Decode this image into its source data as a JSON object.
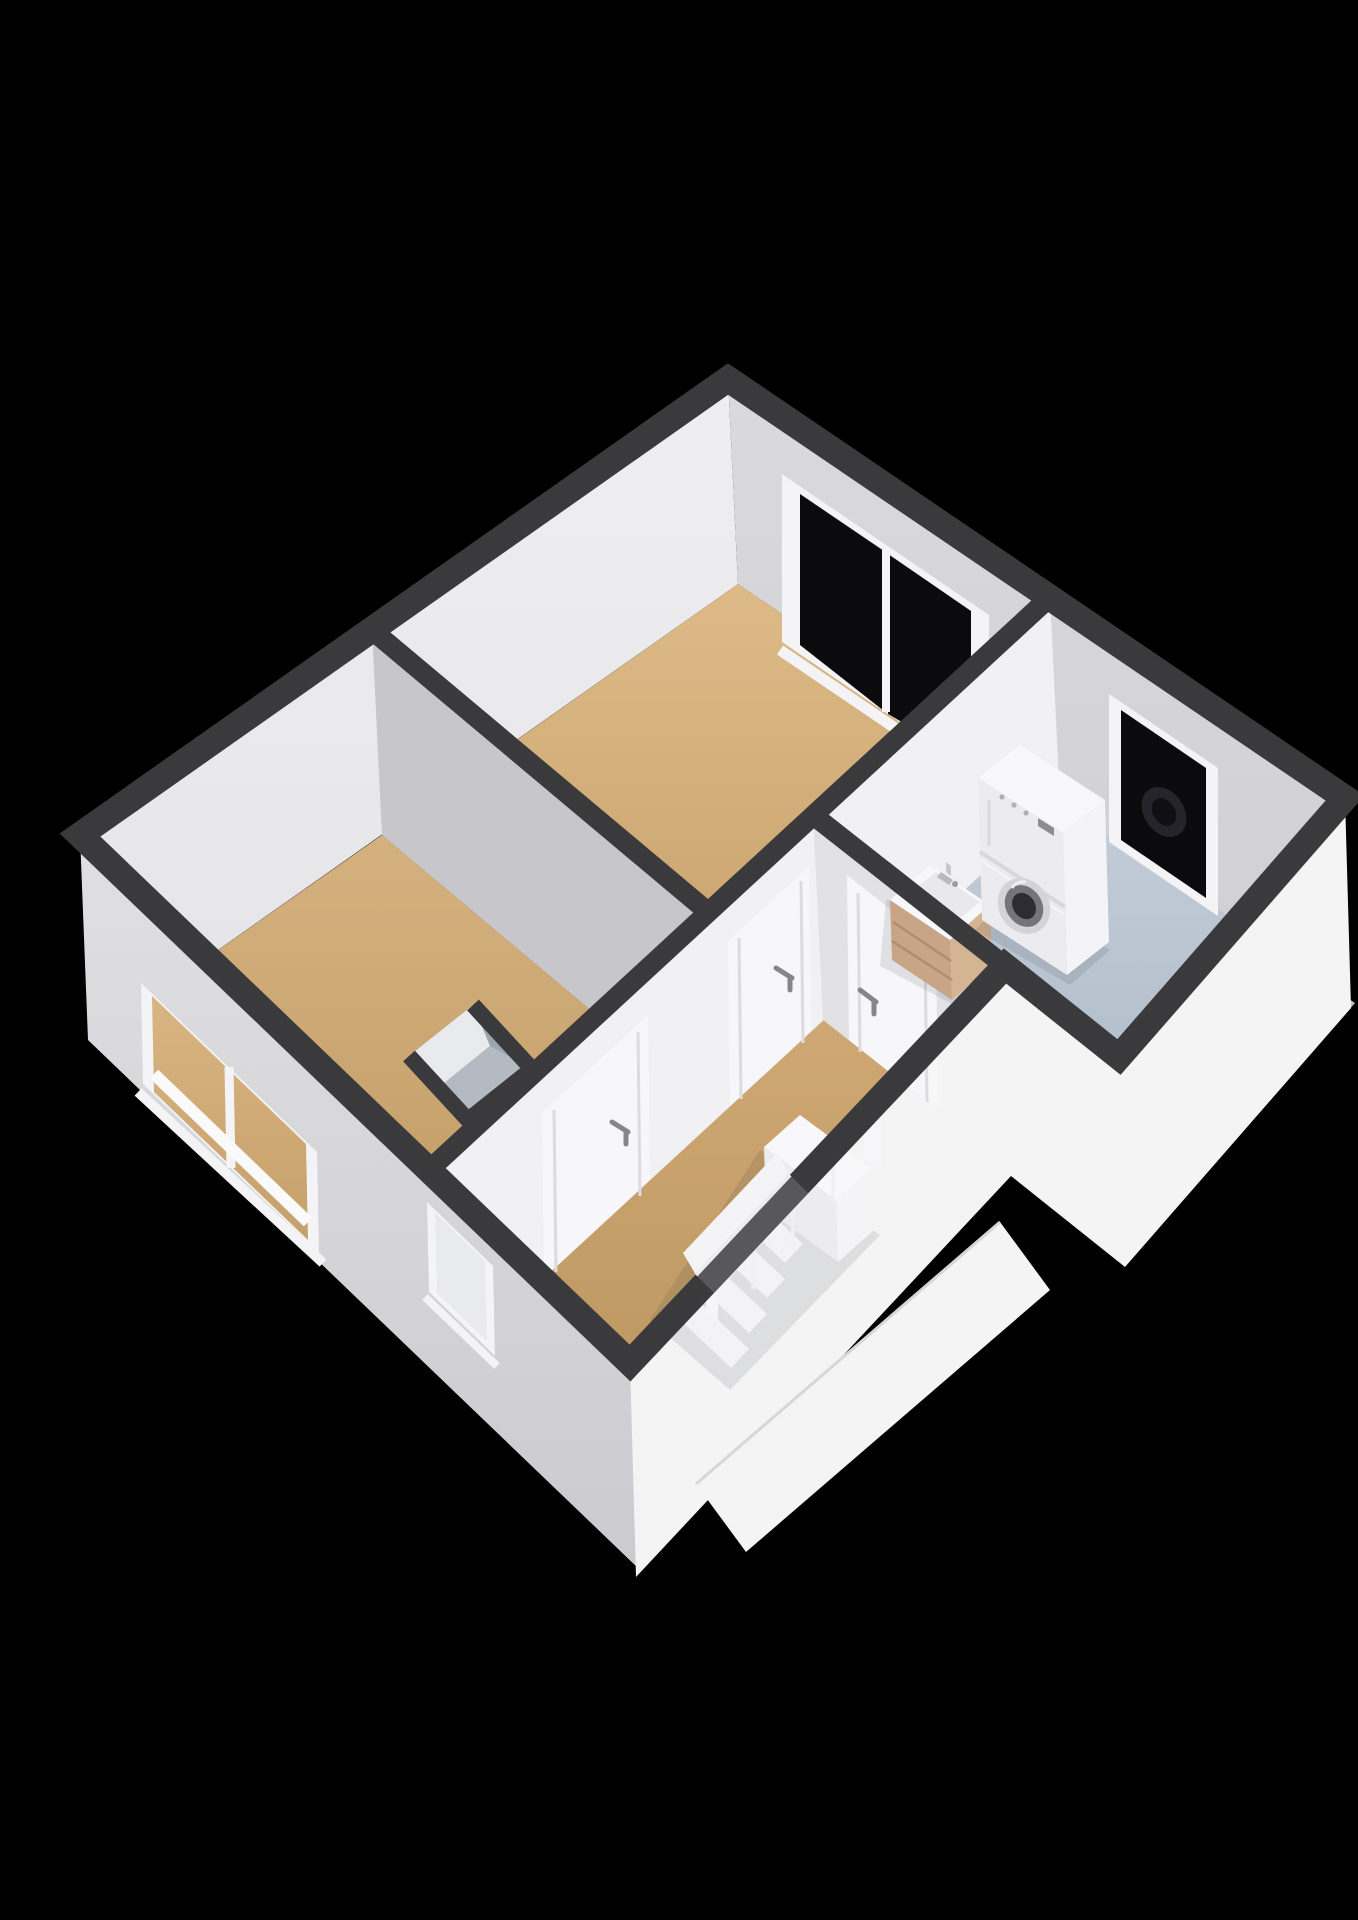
{
  "canvas": {
    "width": 1358,
    "height": 1920,
    "background": "#000000"
  },
  "colors": {
    "bg": "#000000",
    "wall_cap": "#3a3a3d",
    "int_wall_light": "#e6e6e9",
    "int_wall_med": "#d1d1d5",
    "int_wall_shadow": "#c7c7cb",
    "int_wall_bright": "#f1f1f3",
    "int_wall_hall": "#e2e2e5",
    "ext_light": "#f4f4f5",
    "ext_med": "#d7d7da",
    "floor_wood": "#d4b17e",
    "floor_wood_deep": "#c29c66",
    "floor_bath": "#b7c2cf",
    "floor_bath_deep": "#a7b3c2",
    "glass_dark": "#0b0b0e",
    "frame_white": "#f4f4f6",
    "appliance_top": "#f8f8fa",
    "appliance_front": "#ececef",
    "appliance_side": "#f4f4f6",
    "wood_cabinet": "#c8a586",
    "metal": "#c2c2c8",
    "handle": "#85858b",
    "stair_tread": "#f3f3f5",
    "stair_riser": "#dfdfe3",
    "recess": "#57575c",
    "niche_wall_light": "#e8eaed",
    "niche_wall_dark": "#b4bac2"
  },
  "scene": {
    "type": "floorplan-3d",
    "view": "isometric-overview",
    "rooms": [
      {
        "name": "bedroom",
        "floor": "wood"
      },
      {
        "name": "living-room",
        "floor": "wood"
      },
      {
        "name": "bathroom",
        "floor": "tile-blue"
      },
      {
        "name": "hallway",
        "floor": "wood"
      }
    ],
    "fixtures": [
      "washer-dryer-stack",
      "bathroom-vanity-sink",
      "staircase-with-railing",
      "bedroom-window",
      "bathroom-window",
      "living-room-window-large",
      "living-room-window-small",
      "bedroom-door",
      "living-room-door",
      "bathroom-door",
      "entry-doorway",
      "wall-niche"
    ]
  }
}
